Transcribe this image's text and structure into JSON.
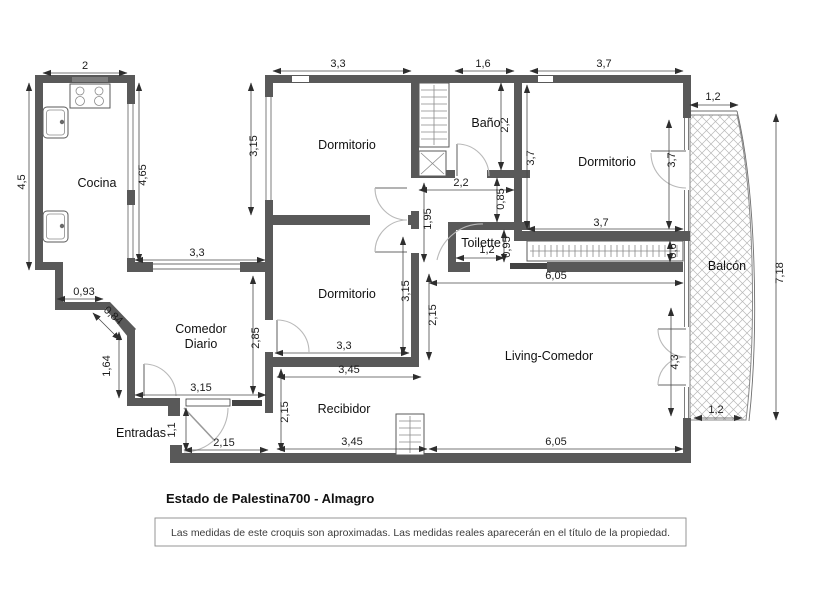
{
  "title": "Estado de Palestina700 - Almagro",
  "disclaimer": "Las medidas de este croquis son aproximadas. Las medidas reales aparecerán en el título de la propiedad.",
  "colors": {
    "wall": "#595959",
    "dimension_text": "#1c1c1c",
    "hatch": "#b8b8b8",
    "background": "#ffffff"
  },
  "rooms": [
    {
      "id": "cocina",
      "label": "Cocina",
      "x": 97,
      "y": 187
    },
    {
      "id": "dormitorio-1",
      "label": "Dormitorio",
      "x": 347,
      "y": 149
    },
    {
      "id": "bano",
      "label": "Baño",
      "x": 486,
      "y": 127
    },
    {
      "id": "dormitorio-3",
      "label": "Dormitorio",
      "x": 607,
      "y": 166
    },
    {
      "id": "toilette",
      "label": "Toilette",
      "x": 481,
      "y": 247
    },
    {
      "id": "dormitorio-2",
      "label": "Dormitorio",
      "x": 347,
      "y": 298
    },
    {
      "id": "comedor-diario",
      "label": "Comedor\nDiario",
      "x": 201,
      "y": 333
    },
    {
      "id": "living-comedor",
      "label": "Living-Comedor",
      "x": 549,
      "y": 360
    },
    {
      "id": "recibidor",
      "label": "Recibidor",
      "x": 344,
      "y": 413
    },
    {
      "id": "entradas",
      "label": "Entradas",
      "x": 141,
      "y": 437
    },
    {
      "id": "balcon",
      "label": "Balcón",
      "x": 727,
      "y": 270
    }
  ],
  "dimensions": [
    {
      "v": "2",
      "x": 85,
      "y": 69,
      "r": 0,
      "l": [
        43,
        73,
        127,
        73
      ]
    },
    {
      "v": "3,3",
      "x": 338,
      "y": 67,
      "r": 0,
      "l": [
        273,
        71,
        411,
        71
      ]
    },
    {
      "v": "1,6",
      "x": 483,
      "y": 67,
      "r": 0,
      "l": [
        455,
        71,
        514,
        71
      ]
    },
    {
      "v": "3,7",
      "x": 604,
      "y": 67,
      "r": 0,
      "l": [
        530,
        71,
        683,
        71
      ]
    },
    {
      "v": "4,5",
      "x": 25,
      "y": 182,
      "r": -90,
      "l": [
        29,
        83,
        29,
        270
      ]
    },
    {
      "v": "4,65",
      "x": 146,
      "y": 175,
      "r": -90,
      "l": [
        139,
        83,
        139,
        262
      ]
    },
    {
      "v": "3,15",
      "x": 257,
      "y": 146,
      "r": -90,
      "l": [
        251,
        83,
        251,
        215
      ]
    },
    {
      "v": "2,2",
      "x": 508,
      "y": 125,
      "r": -90,
      "l": [
        501,
        83,
        501,
        170
      ]
    },
    {
      "v": "3,7",
      "x": 534,
      "y": 158,
      "r": -90,
      "l": [
        527,
        85,
        527,
        229
      ]
    },
    {
      "v": "3,7",
      "x": 675,
      "y": 160,
      "r": -90,
      "l": [
        669,
        120,
        669,
        229
      ]
    },
    {
      "v": "2,2",
      "x": 461,
      "y": 186,
      "r": 0,
      "l": [
        419,
        190,
        514,
        190
      ]
    },
    {
      "v": "0,85",
      "x": 504,
      "y": 199,
      "r": -90,
      "l": [
        497,
        178,
        497,
        222
      ]
    },
    {
      "v": "1,95",
      "x": 431,
      "y": 219,
      "r": -90,
      "l": [
        424,
        183,
        424,
        262
      ]
    },
    {
      "v": "3,3",
      "x": 197,
      "y": 256,
      "r": 0,
      "l": [
        135,
        260,
        265,
        260
      ]
    },
    {
      "v": "3,7",
      "x": 601,
      "y": 226,
      "r": 0,
      "l": [
        527,
        229,
        683,
        229
      ]
    },
    {
      "v": "0,6",
      "x": 676,
      "y": 251,
      "r": -90,
      "l": [
        670,
        241,
        670,
        262
      ]
    },
    {
      "v": "0,95",
      "x": 510,
      "y": 247,
      "r": -90,
      "l": [
        504,
        230,
        504,
        262
      ]
    },
    {
      "v": "1,2",
      "x": 487,
      "y": 253,
      "r": 0,
      "l": [
        456,
        258,
        504,
        258
      ]
    },
    {
      "v": "6,05",
      "x": 556,
      "y": 279,
      "r": 0,
      "l": [
        429,
        283,
        683,
        283
      ]
    },
    {
      "v": "2,85",
      "x": 259,
      "y": 338,
      "r": -90,
      "l": [
        253,
        276,
        253,
        394
      ]
    },
    {
      "v": "3,15",
      "x": 409,
      "y": 291,
      "r": -90,
      "l": [
        403,
        237,
        403,
        355
      ]
    },
    {
      "v": "2,15",
      "x": 436,
      "y": 315,
      "r": -90,
      "l": [
        429,
        274,
        429,
        360
      ]
    },
    {
      "v": "3,3",
      "x": 344,
      "y": 349,
      "r": 0,
      "l": [
        275,
        353,
        409,
        353
      ]
    },
    {
      "v": "3,45",
      "x": 349,
      "y": 373,
      "r": 0,
      "l": [
        277,
        377,
        421,
        377
      ]
    },
    {
      "v": "0,93",
      "x": 84,
      "y": 295,
      "r": 0,
      "l": [
        57,
        299,
        103,
        299
      ]
    },
    {
      "v": "0,84",
      "x": 111,
      "y": 318,
      "r": 42,
      "l": [
        93,
        313,
        120,
        340
      ]
    },
    {
      "v": "1,64",
      "x": 110,
      "y": 366,
      "r": -90,
      "l": [
        119,
        332,
        119,
        398
      ]
    },
    {
      "v": "3,15",
      "x": 201,
      "y": 391,
      "r": 0,
      "l": [
        135,
        395,
        266,
        395
      ]
    },
    {
      "v": "1,1",
      "x": 175,
      "y": 430,
      "r": -90,
      "l": [
        186,
        408,
        186,
        451
      ]
    },
    {
      "v": "2,15",
      "x": 224,
      "y": 446,
      "r": 0,
      "l": [
        184,
        450,
        268,
        450
      ]
    },
    {
      "v": "2,15",
      "x": 288,
      "y": 412,
      "r": -90,
      "l": [
        281,
        369,
        281,
        451
      ]
    },
    {
      "v": "3,45",
      "x": 352,
      "y": 445,
      "r": 0,
      "l": [
        277,
        449,
        427,
        449
      ]
    },
    {
      "v": "6,05",
      "x": 556,
      "y": 445,
      "r": 0,
      "l": [
        429,
        449,
        683,
        449
      ]
    },
    {
      "v": "4,3",
      "x": 678,
      "y": 362,
      "r": -90,
      "l": [
        671,
        308,
        671,
        416
      ]
    },
    {
      "v": "1,2",
      "x": 713,
      "y": 100,
      "r": 0,
      "l": [
        690,
        105,
        738,
        105
      ]
    },
    {
      "v": "1,2",
      "x": 716,
      "y": 413,
      "r": 0,
      "l": [
        694,
        418,
        742,
        418
      ]
    },
    {
      "v": "7,18",
      "x": 783,
      "y": 273,
      "r": -90,
      "l": [
        776,
        114,
        776,
        420
      ]
    }
  ]
}
